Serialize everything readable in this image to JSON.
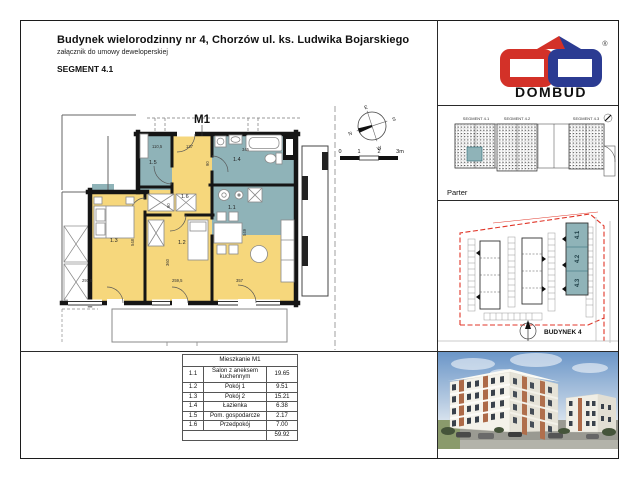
{
  "header": {
    "title": "Budynek wielorodzinny nr 4, Chorzów ul. ks. Ludwika Bojarskiego",
    "subtitle": "załącznik do umowy deweloperskiej",
    "segment": "SEGMENT 4.1"
  },
  "logo": {
    "text": "DOMBUD",
    "registered_mark": "®"
  },
  "plan": {
    "unit_label": "M1",
    "room_labels": {
      "r11": "1.1",
      "r12": "1.2",
      "r13": "1.3",
      "r14": "1.4",
      "r15": "1.5",
      "r16": "1.6"
    },
    "dims": {
      "d1105": "110,5",
      "d137": "137",
      "d345": "345",
      "d2915": "291,5",
      "d2595": "259,5",
      "d357": "357",
      "d548": "548",
      "d360": "360",
      "d549": "549",
      "d90a": "90",
      "d90b": "90"
    }
  },
  "compass": {
    "n": "N",
    "e": "E",
    "s": "S",
    "w": "W"
  },
  "scale_bar": {
    "t0": "0",
    "t1": "1",
    "t2": "2",
    "t3": "3m"
  },
  "overview": {
    "segments": [
      "SEGMENT 4.1",
      "SEGMENT 4.2",
      "SEGMENT 4.3"
    ],
    "floor_label": "Parter"
  },
  "site_plan": {
    "unit_labels": [
      "4.1",
      "4.2",
      "4.3"
    ],
    "building_label": "BUDYNEK 4"
  },
  "area_table": {
    "title": "Mieszkanie M1",
    "rows": [
      {
        "no": "1.1",
        "name": "Salon z aneksem kuchennym",
        "area": "19.65"
      },
      {
        "no": "1.2",
        "name": "Pokój 1",
        "area": "9.51"
      },
      {
        "no": "1.3",
        "name": "Pokój 2",
        "area": "15.21"
      },
      {
        "no": "1.4",
        "name": "Łazienka",
        "area": "6.38"
      },
      {
        "no": "1.5",
        "name": "Pom. gospodarcze",
        "area": "2.17"
      },
      {
        "no": "1.6",
        "name": "Przedpokój",
        "area": "7.00"
      }
    ],
    "total": "59.92"
  },
  "colors": {
    "room_warm_yellow": "#f6d77c",
    "room_cool_teal": "#8fb3b8",
    "logo_red": "#d33128",
    "logo_blue": "#2b3b92",
    "site_boundary_red": "#e03528",
    "wall_black": "#151515"
  }
}
